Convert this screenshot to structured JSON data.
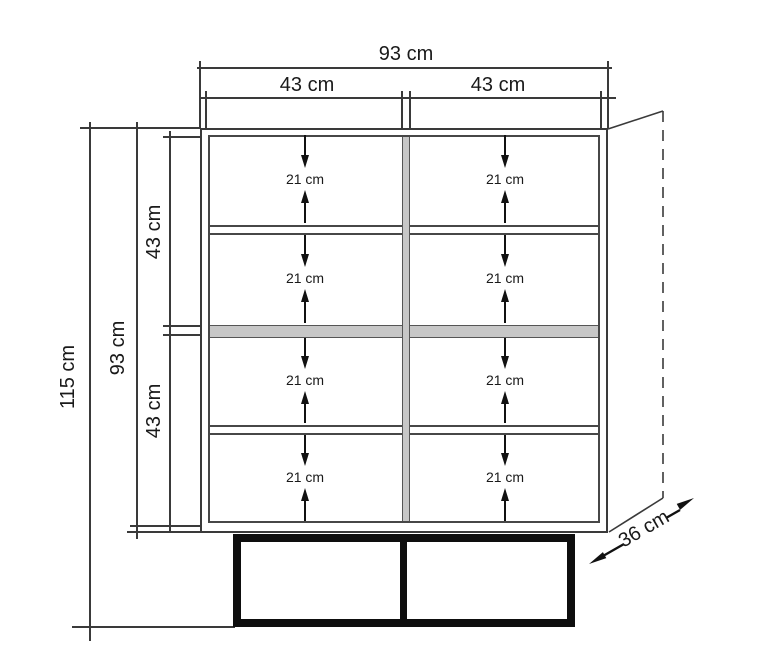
{
  "diagram": {
    "type": "furniture-dimension-drawing",
    "subject": "two-compartment cabinet with shelves and base frame"
  },
  "dimensions": {
    "total_width": "93 cm",
    "left_compartment_width": "43 cm",
    "right_compartment_width": "43 cm",
    "total_height": "115 cm",
    "body_height": "93 cm",
    "upper_section_height": "43 cm",
    "lower_section_height": "43 cm",
    "depth": "36 cm"
  },
  "shelf_cells": [
    {
      "label": "21 cm"
    },
    {
      "label": "21 cm"
    },
    {
      "label": "21 cm"
    },
    {
      "label": "21 cm"
    },
    {
      "label": "21 cm"
    },
    {
      "label": "21 cm"
    },
    {
      "label": "21 cm"
    },
    {
      "label": "21 cm"
    }
  ],
  "colors": {
    "line": "#3a3a3a",
    "shelf_fill": "#c7c7c7",
    "base_fill": "#0e0e0e",
    "background": "#ffffff"
  }
}
